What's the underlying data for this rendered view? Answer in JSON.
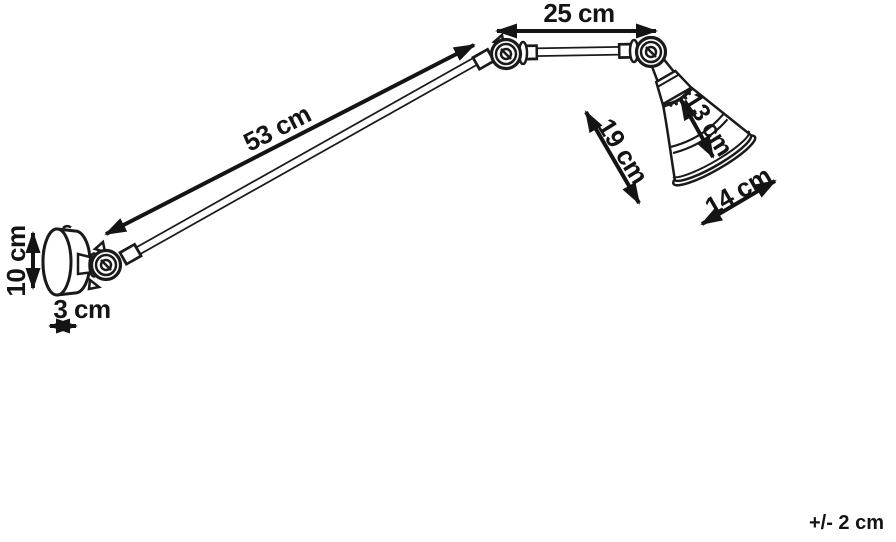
{
  "dimensions": {
    "upper_arm_length": "25 cm",
    "lower_arm_length": "53 cm",
    "shade_inner_height": "13 cm",
    "shade_depth": "19 cm",
    "shade_opening_diameter": "14 cm",
    "wall_plate_diameter": "10 cm",
    "wall_plate_depth": "3 cm"
  },
  "tolerance_note": "+/- 2 cm",
  "colors": {
    "line": "#1a1a1a",
    "label": "#141414",
    "background": "#ffffff"
  }
}
